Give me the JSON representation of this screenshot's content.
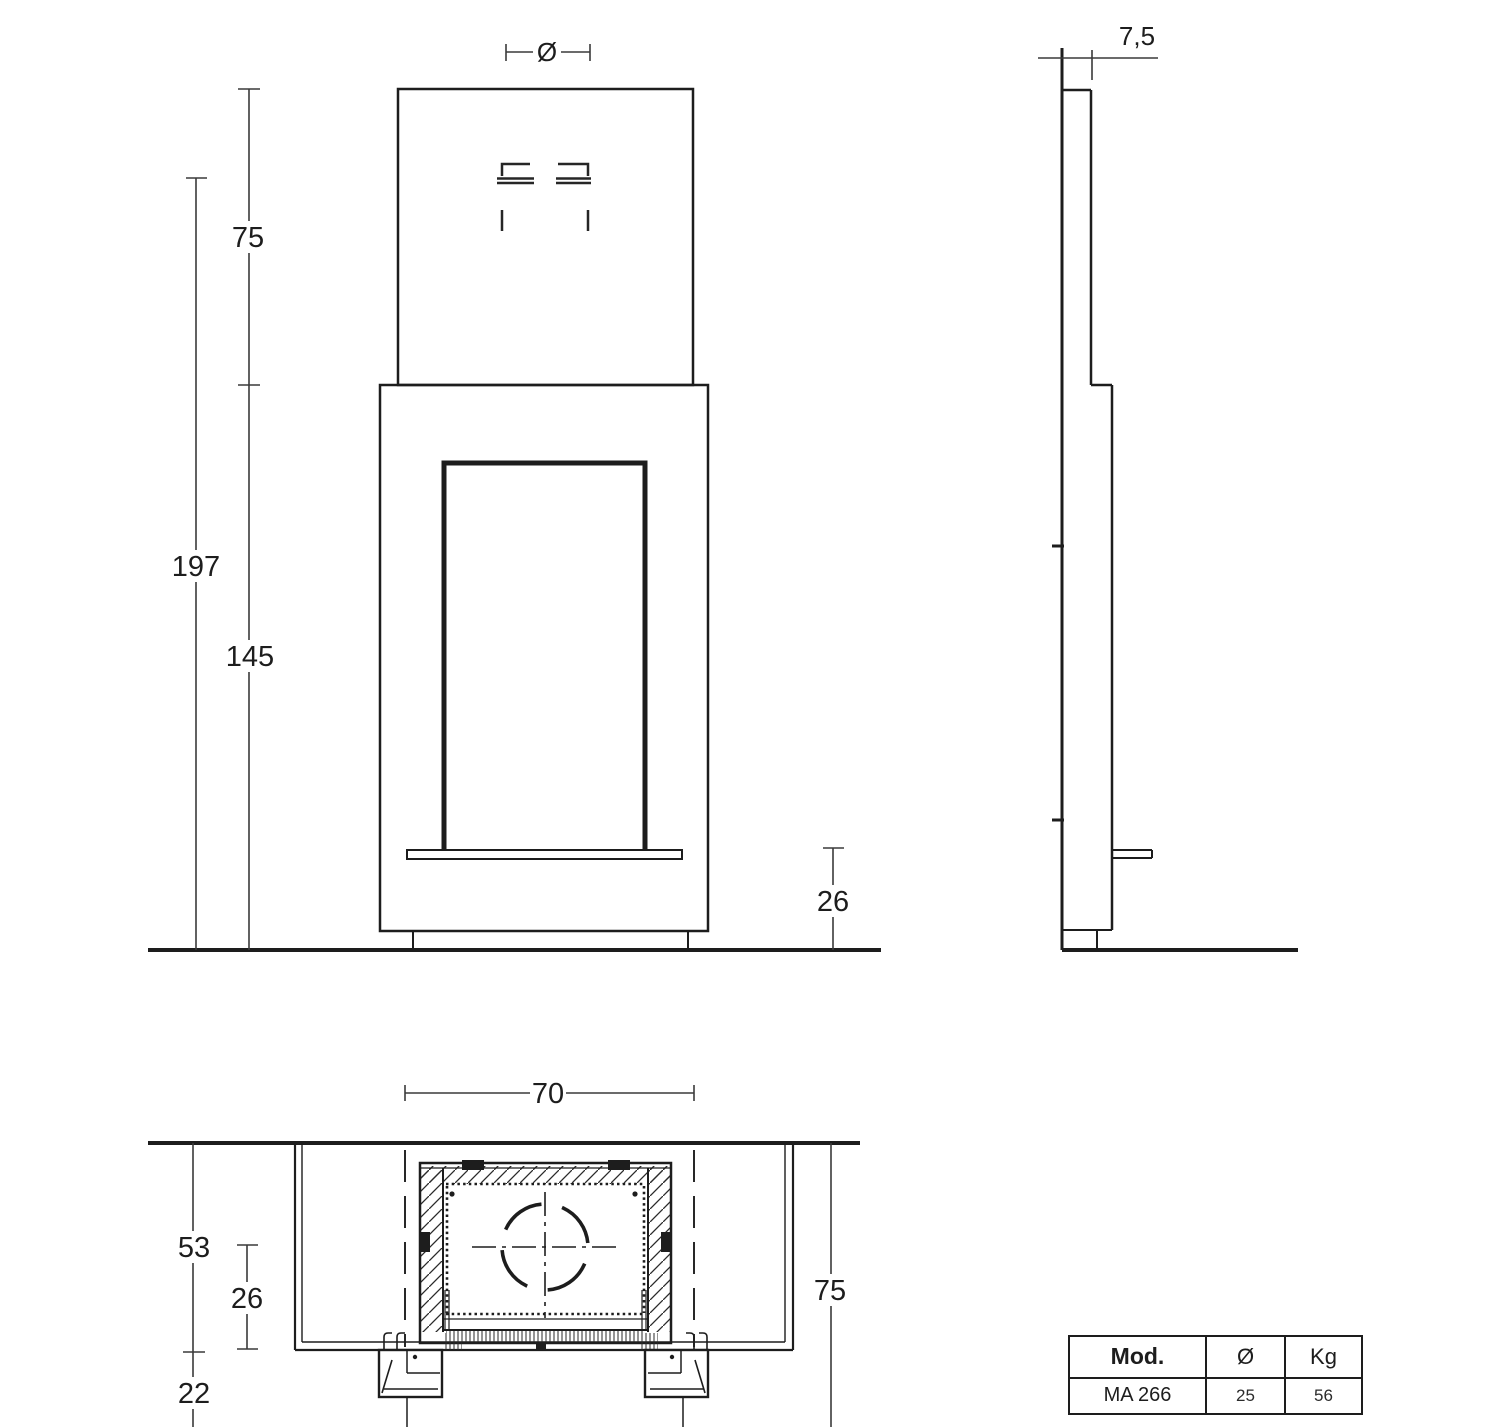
{
  "colors": {
    "line": "#1d1d1d",
    "background": "#ffffff"
  },
  "front_view": {
    "labels": {
      "flue_diameter": "Ø",
      "upper_height": "75",
      "total_height": "197",
      "body_height": "145",
      "base_height": "26"
    }
  },
  "side_view": {
    "labels": {
      "top_depth": "7,5"
    }
  },
  "plan_view": {
    "labels": {
      "firebox_width": "70",
      "total_depth": "53",
      "flue_axis_depth": "26",
      "front_overhang": "22",
      "side_dim": "75"
    }
  },
  "spec_table": {
    "headers": [
      "Mod.",
      "Ø",
      "Kg"
    ],
    "rows": [
      [
        "MA 266",
        "25",
        "56"
      ]
    ]
  }
}
